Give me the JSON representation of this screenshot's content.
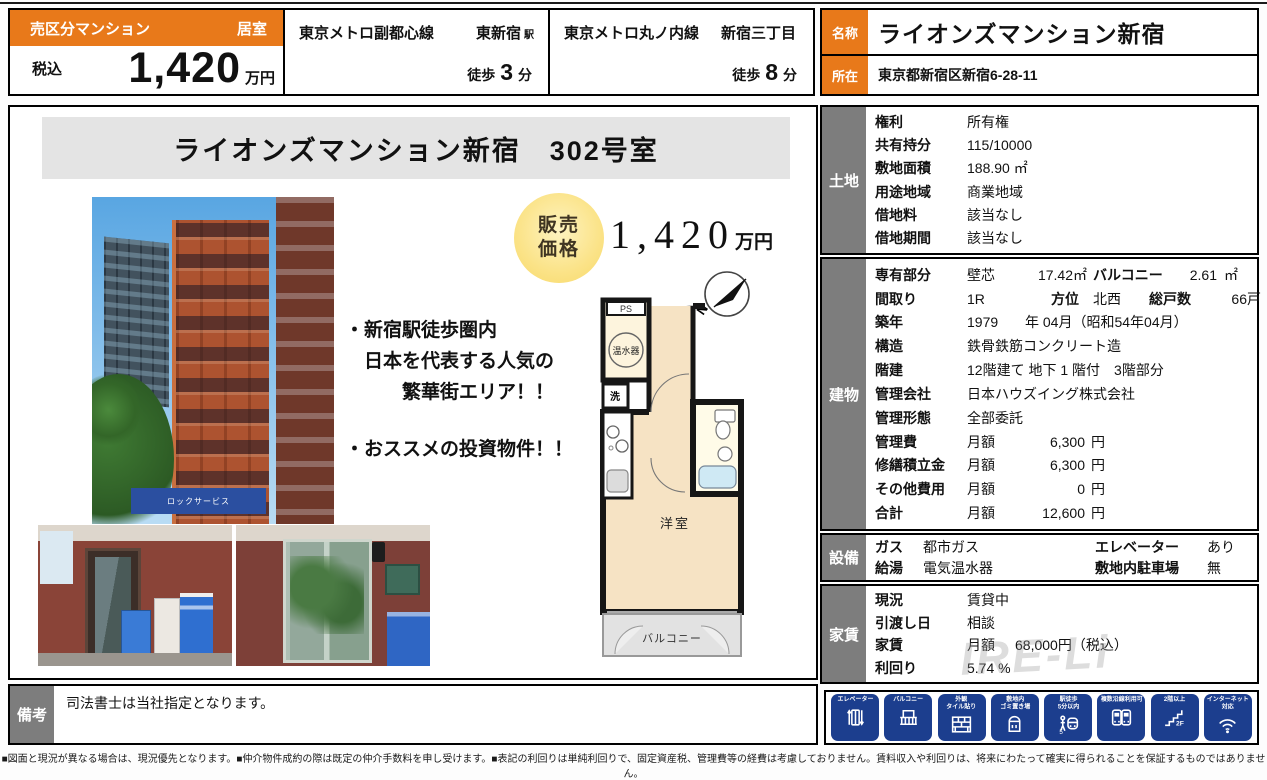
{
  "header": {
    "property_type": "売区分マンション",
    "room_type": "居室",
    "tax_label": "税込",
    "price_value": "1,420",
    "price_unit": "万円",
    "stations": [
      {
        "line": "東京メトロ副都心線",
        "station": "東新宿",
        "suffix": "駅",
        "walk_label": "徒歩",
        "minutes": "3",
        "min_unit": "分"
      },
      {
        "line": "東京メトロ丸ノ内線",
        "station": "新宿三丁目",
        "suffix": "",
        "walk_label": "徒歩",
        "minutes": "8",
        "min_unit": "分"
      }
    ],
    "name_label": "名称",
    "name_value": "ライオンズマンション新宿",
    "address_label": "所在",
    "address_value": "東京都新宿区新宿6-28-11"
  },
  "main": {
    "title": "ライオンズマンション新宿　302号室",
    "badge_line1": "販売",
    "badge_line2": "価格",
    "price_num": "1,420",
    "price_unit": "万円",
    "bullets": [
      [
        "・新宿駅徒歩圏内",
        "　日本を代表する人気の",
        "　　　繁華街エリア！！"
      ],
      [
        "・おススメの投資物件！！"
      ]
    ],
    "photo_sign_text": "ロックサービス",
    "floorplan": {
      "ps": "PS",
      "heater": "温水器",
      "wash": "洗",
      "room": "洋室",
      "balcony": "バルコニー",
      "north": "N"
    }
  },
  "sections": {
    "land": {
      "title": "土地",
      "label_w": 92,
      "rows": [
        {
          "label": "権利",
          "cells": [
            {
              "t": "所有権"
            }
          ]
        },
        {
          "label": "共有持分",
          "cells": [
            {
              "t": "115/10000"
            }
          ]
        },
        {
          "label": "敷地面積",
          "cells": [
            {
              "t": "188.90 ㎡"
            }
          ]
        },
        {
          "label": "用途地域",
          "cells": [
            {
              "t": "商業地域"
            }
          ]
        },
        {
          "label": "借地料",
          "cells": [
            {
              "t": "該当なし"
            }
          ]
        },
        {
          "label": "借地期間",
          "cells": [
            {
              "t": "該当なし"
            }
          ]
        }
      ]
    },
    "building": {
      "title": "建物",
      "label_w": 92,
      "rows": [
        {
          "label": "専有部分",
          "cells": [
            {
              "t": "壁芯",
              "w": 58
            },
            {
              "t": "17.42㎡",
              "w": 62,
              "a": "r"
            },
            {
              "t": "バルコニー",
              "b": 1,
              "w": 74,
              "pl": 6
            },
            {
              "t": "2.61",
              "w": 56,
              "a": "r"
            },
            {
              "t": "㎡",
              "w": 28,
              "a": "c"
            }
          ]
        },
        {
          "label": "間取り",
          "cells": [
            {
              "t": "1R",
              "w": 84
            },
            {
              "t": "方位",
              "b": 1,
              "w": 42
            },
            {
              "t": "北西",
              "w": 56
            },
            {
              "t": "総戸数",
              "b": 1,
              "w": 78
            },
            {
              "t": "66戸",
              "w": 34,
              "a": "r"
            }
          ]
        },
        {
          "label": "築年",
          "cells": [
            {
              "t": "1979",
              "w": 58
            },
            {
              "t": "年 04月（昭和54年04月）"
            }
          ]
        },
        {
          "label": "構造",
          "cells": [
            {
              "t": "鉄骨鉄筋コンクリート造"
            }
          ]
        },
        {
          "label": "階建",
          "cells": [
            {
              "t": "12階建て 地下 1 階付　3階部分"
            }
          ]
        },
        {
          "label": "管理会社",
          "cells": [
            {
              "t": "日本ハウズイング株式会社"
            }
          ]
        },
        {
          "label": "管理形態",
          "cells": [
            {
              "t": "全部委託"
            }
          ]
        },
        {
          "label": "管理費",
          "cells": [
            {
              "t": "月額",
              "w": 56
            },
            {
              "t": "6,300",
              "w": 62,
              "a": "r"
            },
            {
              "t": "円",
              "w": 26,
              "a": "c"
            }
          ]
        },
        {
          "label": "修繕積立金",
          "cells": [
            {
              "t": "月額",
              "w": 56
            },
            {
              "t": "6,300",
              "w": 62,
              "a": "r"
            },
            {
              "t": "円",
              "w": 26,
              "a": "c"
            }
          ]
        },
        {
          "label": "その他費用",
          "cells": [
            {
              "t": "月額",
              "w": 56
            },
            {
              "t": "0",
              "w": 62,
              "a": "r"
            },
            {
              "t": "円",
              "w": 26,
              "a": "c"
            }
          ]
        },
        {
          "label": "合計",
          "cells": [
            {
              "t": "月額",
              "w": 56
            },
            {
              "t": "12,600",
              "w": 62,
              "a": "r"
            },
            {
              "t": "円",
              "w": 26,
              "a": "c"
            }
          ]
        }
      ]
    },
    "equipment": {
      "title": "設備",
      "label_w": 48,
      "rows": [
        {
          "label": "ガス",
          "cells": [
            {
              "t": "都市ガス",
              "w": 172
            },
            {
              "t": "エレベーター",
              "b": 1,
              "w": 112
            },
            {
              "t": "あり"
            }
          ]
        },
        {
          "label": "給湯",
          "cells": [
            {
              "t": "電気温水器",
              "w": 172
            },
            {
              "t": "敷地内駐車場",
              "b": 1,
              "w": 112
            },
            {
              "t": "無"
            }
          ]
        }
      ]
    },
    "rent": {
      "title": "家賃",
      "label_w": 92,
      "rows": [
        {
          "label": "現況",
          "cells": [
            {
              "t": "賃貸中"
            }
          ]
        },
        {
          "label": "引渡し日",
          "cells": [
            {
              "t": "相談"
            }
          ]
        },
        {
          "label": "家賃",
          "cells": [
            {
              "t": "月額",
              "w": 48
            },
            {
              "t": "68,000円（税込）"
            }
          ]
        },
        {
          "label": "利回り",
          "cells": [
            {
              "t": "5.74 %"
            }
          ]
        }
      ]
    }
  },
  "features": [
    {
      "name": "elevator",
      "lines": [
        "エレベーター"
      ]
    },
    {
      "name": "balcony",
      "lines": [
        "バルコニー"
      ]
    },
    {
      "name": "tile",
      "lines": [
        "外観",
        "タイル貼り"
      ]
    },
    {
      "name": "trash",
      "lines": [
        "敷地内",
        "ゴミ置き場"
      ]
    },
    {
      "name": "walk5",
      "lines": [
        "駅徒歩",
        "5分以内"
      ]
    },
    {
      "name": "trains",
      "lines": [
        "複数沿線利用可"
      ]
    },
    {
      "name": "stairs",
      "lines": [
        "2階以上"
      ]
    },
    {
      "name": "wifi",
      "lines": [
        "インターネット",
        "対応"
      ]
    }
  ],
  "remarks": {
    "label": "備考",
    "text": "司法書士は当社指定となります。"
  },
  "footer": {
    "disclaimer": "■図面と現況が異なる場合は、現況優先となります。■仲介物件成約の際は既定の仲介手数料を申し受けます。■表記の利回りは単純利回りで、固定資産税、管理費等の経費は考慮しておりません。賃料収入や利回りは、将来にわたって確実に得られることを保証するものではありません。"
  },
  "watermark": {
    "text": "IRE-Li"
  },
  "colors": {
    "accent_orange": "#e8791a",
    "section_gray": "#7d7d7d",
    "icon_blue": "#1c3e8e"
  }
}
